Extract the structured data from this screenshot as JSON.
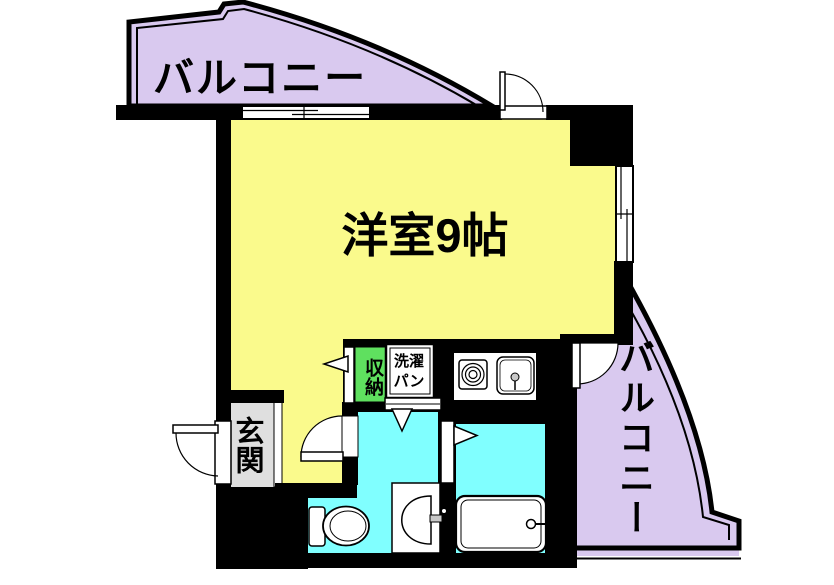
{
  "plan": {
    "type": "apartment-floor-plan",
    "rooms": {
      "main_room": {
        "label": "洋室9帖"
      },
      "balcony_top": {
        "label": "バルコニー"
      },
      "balcony_right": {
        "label": "バルコニー"
      },
      "entrance": {
        "label": "玄関"
      },
      "pipe_space": {
        "label": "PS"
      },
      "closet": {
        "label": "収納"
      },
      "laundry_pan": {
        "label": "洗濯パン"
      }
    },
    "fixtures": [
      "toilet",
      "washbasin",
      "bathtub",
      "stove-burner",
      "kitchen-sink",
      "washing-machine-pan",
      "sliding-windows",
      "swing-doors"
    ],
    "colors": {
      "room_yellow": "#FAFA8C",
      "balcony_lavender": "#D9C9EF",
      "wet_area_cyan": "#80FFFF",
      "closet_green": "#5FE05F",
      "entrance_gray": "#DFDFDF",
      "wall_black": "#000000",
      "fixture_white": "#FFFFFF",
      "faucet_gray": "#C8C8C8"
    }
  }
}
